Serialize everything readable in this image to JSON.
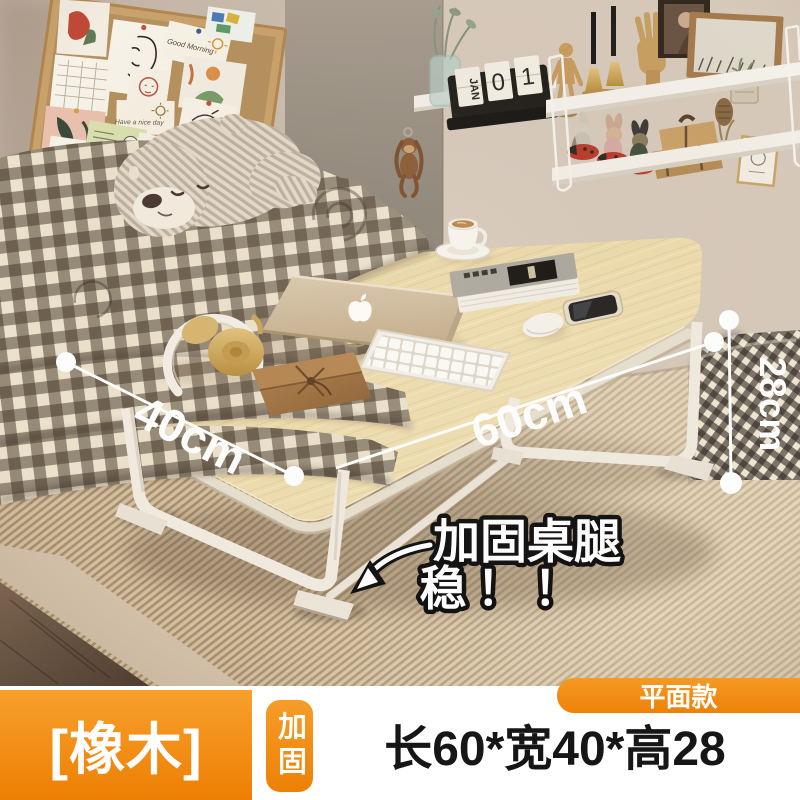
{
  "annotations": {
    "width_label": "40cm",
    "length_label": "60cm",
    "height_label": "28cm",
    "callout_line1": "加固桌腿",
    "callout_line2": "稳！！"
  },
  "corkboard": {
    "morning_note": "Good Morning",
    "nice_day_note": "Have a nice day"
  },
  "shelf": {
    "calendar_month": "JAN",
    "calendar_digit_left": "0",
    "calendar_digit_right": "1"
  },
  "footer": {
    "material": "[橡木]",
    "reinforced": "加固",
    "size": "长60*宽40*高28",
    "style": "平面款"
  },
  "colors": {
    "accent_orange": "#f2880f",
    "table_wood": "#ecd9a8",
    "leg_white": "#f1ebe0",
    "wall_beige": "#cdbfb0"
  }
}
